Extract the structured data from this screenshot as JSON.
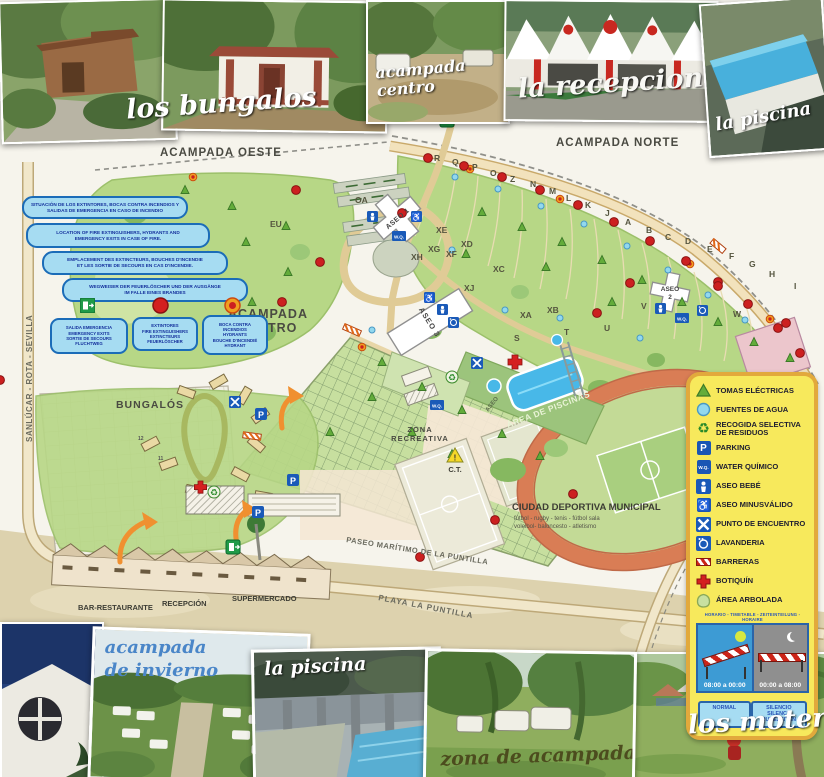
{
  "photos": {
    "top": [
      {
        "caption": "los bungalos"
      },
      {
        "caption": "acampada centro"
      },
      {
        "caption": "la recepcion"
      },
      {
        "caption": "la piscina"
      }
    ],
    "bottom": [
      {
        "caption": "acampada de invierno"
      },
      {
        "caption": "la piscina"
      },
      {
        "caption": "zona de acampada"
      },
      {
        "caption": "los moteros"
      }
    ]
  },
  "map": {
    "areas": {
      "oeste": "ACAMPADA OESTE",
      "norte": "ACAMPADA NORTE",
      "centro_line1": "ACAMPADA",
      "centro_line2": "CENTRO",
      "bungalos": "BUNGALÓS",
      "zona_recreativa_line1": "ZONA",
      "zona_recreativa_line2": "RECREATIVA",
      "area_piscinas": "ÁREA DE PISCINAS",
      "aseo_piscinas": "ASEO",
      "ciudad_deportiva": "CIUDAD DEPORTIVA MUNICIPAL",
      "ciudad_deportiva_sub1": "fútbol - rugby - tenis - fútbol sala",
      "ciudad_deportiva_sub2": "voleibol- baloncesto - atletismo",
      "ct": "C.T."
    },
    "buildings": {
      "aseo1": "ASEO 1",
      "aseo2_line1": "ASEO",
      "aseo2_line2": "2",
      "aseo3": "ASEO 3",
      "bar": "BAR-RESTAURANTE",
      "recepcion": "RECEPCIÓN",
      "supermercado": "SUPERMERCADO"
    },
    "roads": {
      "sanlucar": "SANLÚCAR - ROTA - SEVILLA",
      "paseo": "PASEO MARÍTIMO DE LA PUNTILLA",
      "playa": "PLAYA LA PUNTILLA",
      "cadiz": "CÁDIZ - CENTRO CIUDAD"
    },
    "zones": [
      "R",
      "Q",
      "P",
      "O",
      "Z",
      "N",
      "M",
      "L",
      "K",
      "J",
      "A",
      "B",
      "C",
      "D",
      "E",
      "F",
      "G",
      "H",
      "I",
      "XE",
      "XD",
      "XG",
      "XF",
      "XH",
      "XC",
      "XJ",
      "XA",
      "XB",
      "S",
      "T",
      "U",
      "V",
      "W",
      "EU",
      "OA"
    ],
    "plot_numbers": [
      "12",
      "11"
    ],
    "icon_texts": {
      "parking": "P",
      "wq": "W.Q."
    }
  },
  "fire_info": {
    "boxes": [
      "SITUACIÓN DE LOS EXTINTORES, BOCAS CONTRA INCENDIOS Y\nSALIDAS DE EMERGENCIA EN CASO DE INCENDIO",
      "LOCATION OF FIRE EXTINGUISHERS, HYDRANTS AND\nEMERGENCY EXITS IN CASE OF FIRE.",
      "EMPLACEMENT DES EXTINCTEURS, BOUCHES D'INCENDIE\nET LES SORTIE DE SECOURS EN CAS D'INCENDIE.",
      "WEGWEISER DER FEUERLÖSCHER UND DER AUSGÄNGE\nIM FALLE EINES BRANDES"
    ],
    "markers": [
      "SALIDA EMERGENCIA\nEMERGENCY EXITS\nSORTIE DE SECOURS\nFLUCHTWEG",
      "EXTINTORES\nFIRE EXTINGUISHERS\nEXTINCTEURS\nFEUERLÖSCHER",
      "BOCA CONTRA\nINCENDIOS\nHYDRANTS\nBOUCHE D'INCENDIÉ\nHYDRANT"
    ]
  },
  "legend": {
    "items": [
      {
        "icon": "electric-triangle",
        "label": "TOMAS ELÉCTRICAS"
      },
      {
        "icon": "water-fountain",
        "label": "FUENTES DE AGUA"
      },
      {
        "icon": "recycle",
        "label": "RECOGIDA SELECTIVA\nDE RESIDUOS"
      },
      {
        "icon": "parking",
        "label": "PARKING"
      },
      {
        "icon": "chemical-toilet",
        "label": "WATER QUÍMICO"
      },
      {
        "icon": "baby-room",
        "label": "ASEO BEBÉ"
      },
      {
        "icon": "accessible-toilet",
        "label": "ASEO MINUSVÁLIDO"
      },
      {
        "icon": "meeting-point",
        "label": "PUNTO DE ENCUENTRO"
      },
      {
        "icon": "laundry",
        "label": "LAVANDERIA"
      },
      {
        "icon": "barrier",
        "label": "BARRERAS"
      },
      {
        "icon": "first-aid",
        "label": "BOTIQUÍN"
      },
      {
        "icon": "wooded-area",
        "label": "ÁREA ARBOLADA"
      }
    ],
    "schedule": {
      "header": "HORARIO - TIMETABLE - ZEITEINTEILUNG - HORAIRE",
      "day_time": "08:00 a 00:00",
      "night_time": "00:00 a 08:00",
      "day_label": "NORMAL",
      "night_label": "SILENCIO\nSILENCE\nRUHEZEITEN"
    },
    "colors": {
      "panel_bg": "#f7e95c",
      "panel_border": "#e2a93c",
      "info_blue": "#a6dcf2",
      "info_border": "#1b6cb8",
      "extinguisher_red": "#cc2020",
      "hydrant_orange": "#f0a020",
      "exit_green": "#2a9a4a"
    }
  }
}
